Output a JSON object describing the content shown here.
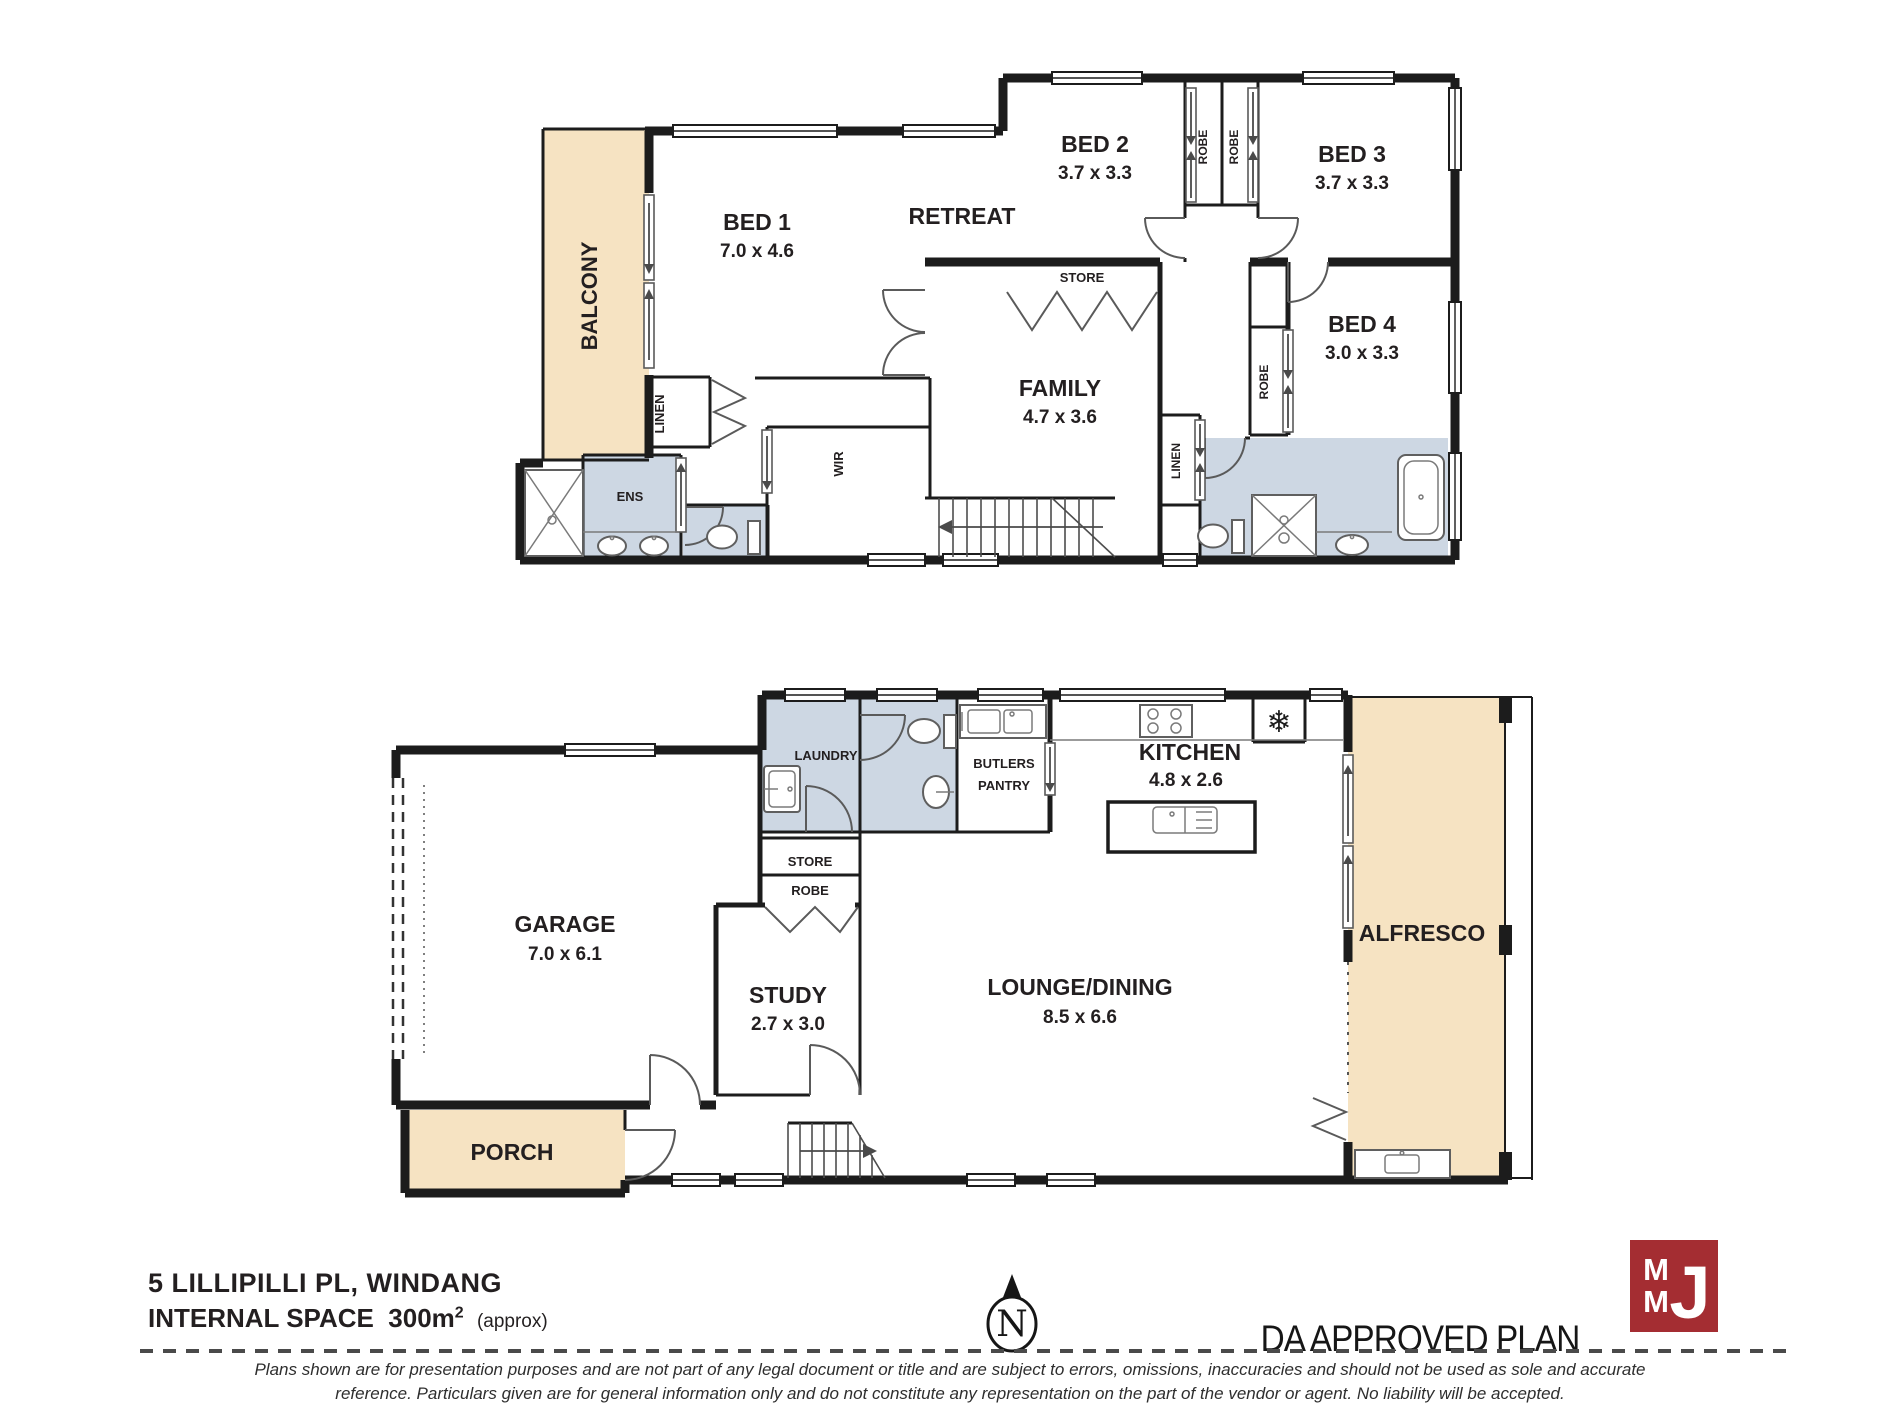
{
  "colors": {
    "tan": "#F6E3C2",
    "wet": "#CDD7E3",
    "wall": "#1C1C1C",
    "logo_red": "#A42D32"
  },
  "upper_floor": {
    "balcony": {
      "label": "BALCONY"
    },
    "bed1": {
      "label": "BED 1",
      "dims": "7.0 x 4.6"
    },
    "retreat": {
      "label": "RETREAT"
    },
    "bed2": {
      "label": "BED 2",
      "dims": "3.7 x 3.3"
    },
    "bed3": {
      "label": "BED 3",
      "dims": "3.7 x 3.3"
    },
    "bed4": {
      "label": "BED 4",
      "dims": "3.0 x 3.3"
    },
    "family": {
      "label": "FAMILY",
      "dims": "4.7 x 3.6"
    },
    "store": {
      "label": "STORE"
    },
    "wir": {
      "label": "WIR"
    },
    "ens": {
      "label": "ENS"
    },
    "linen_left": {
      "label": "LINEN"
    },
    "linen_hall": {
      "label": "LINEN"
    },
    "robe_bed2": {
      "label": "ROBE"
    },
    "robe_bed3": {
      "label": "ROBE"
    },
    "robe_bed4": {
      "label": "ROBE"
    }
  },
  "lower_floor": {
    "garage": {
      "label": "GARAGE",
      "dims": "7.0 x 6.1"
    },
    "porch": {
      "label": "PORCH"
    },
    "laundry": {
      "label": "LAUNDRY"
    },
    "store": {
      "label": "STORE"
    },
    "robe": {
      "label": "ROBE"
    },
    "study": {
      "label": "STUDY",
      "dims": "2.7 x 3.0"
    },
    "butlers_pantry": {
      "line1": "BUTLERS",
      "line2": "PANTRY"
    },
    "kitchen": {
      "label": "KITCHEN",
      "dims": "4.8 x 2.6"
    },
    "lounge_dining": {
      "label": "LOUNGE/DINING",
      "dims": "8.5 x 6.6"
    },
    "alfresco": {
      "label": "ALFRESCO"
    }
  },
  "icons": {
    "fridge_snowflake": "❄",
    "north_letter": "N"
  },
  "footer": {
    "address": "5 LILLIPILLI PL, WINDANG",
    "internal_space_label": "INTERNAL SPACE",
    "internal_space_value": "300m",
    "internal_space_sup": "2",
    "internal_space_approx": "(approx)",
    "da_stamp": "DA APPROVED PLAN",
    "logo_m1": "M",
    "logo_m2": "M",
    "logo_j": "J",
    "disclaimer_line1": "Plans shown are for presentation purposes and are not part of any legal document or title and are subject to errors, omissions, inaccuracies and should not be used as sole and accurate",
    "disclaimer_line2": "reference. Particulars given are for general information only and do not constitute any representation on the part of the vendor or agent. No liability will be accepted."
  }
}
